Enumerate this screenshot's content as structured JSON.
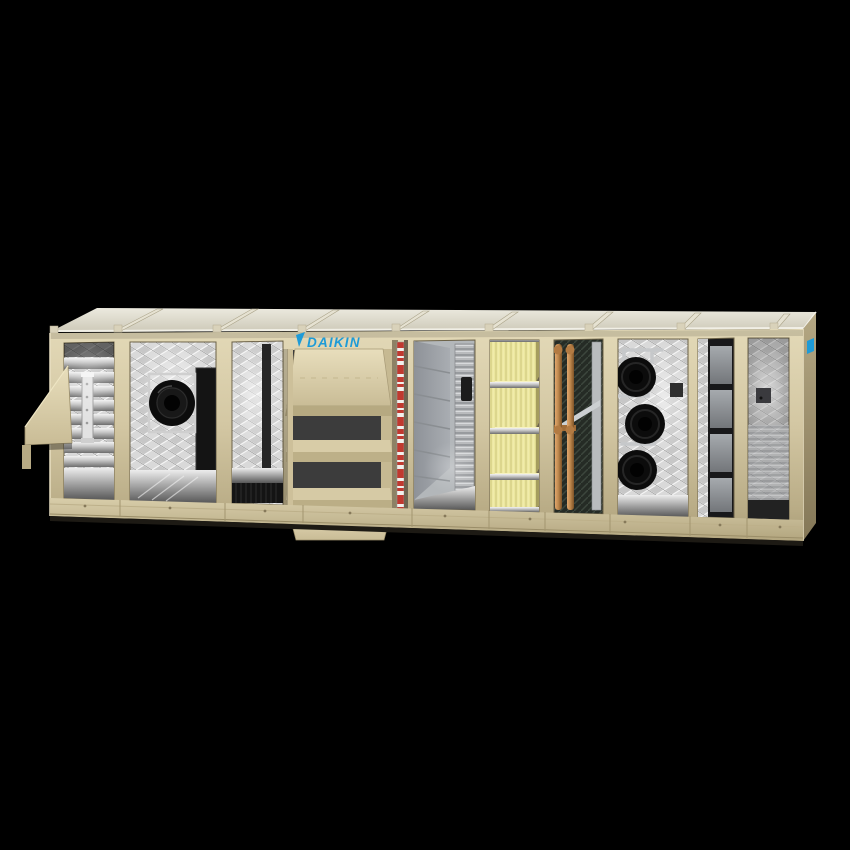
{
  "brand": {
    "logo_text": "DAIKIN"
  },
  "colors": {
    "background": "#000000",
    "cabinet": "#d0c4a1",
    "cabinet_light": "#e5dcba",
    "cabinet_dark": "#a69974",
    "roof": "#dcd9cb",
    "logo_blue": "#1e9bd7",
    "filter_yellow": "#ece79e",
    "copper": "#c08a4f",
    "fan_black": "#0c0c0c",
    "steel": "#c6c6c6",
    "warning_red": "#c0392f"
  }
}
